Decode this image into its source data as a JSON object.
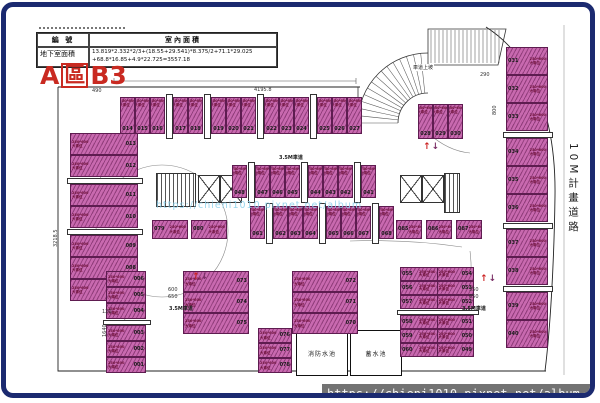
{
  "header": {
    "title": "A區B3",
    "title_parts": {
      "p1": "A",
      "p2": "區",
      "p3": "B3"
    },
    "table": {
      "col1_header": "編 號",
      "col2_header": "室內面積",
      "row_label": "地下室面積",
      "formula_line1": "13.819*2.332*2/3+(18.55+29.541)*8.375/2+71.1*29.025",
      "formula_line2": "+68.8*16.85+4.9*22.725=3557.18"
    }
  },
  "labels": {
    "road": "10M計畫道路",
    "ramp": "車道上坡",
    "aisle": "3.5M車道",
    "stall_note_line1": "250*600",
    "stall_note_line2": "大車位",
    "room1": "消防水池",
    "room2": "蓄水池"
  },
  "icons": {
    "up_arrow": "↑",
    "down_arrow": "↓"
  },
  "watermark": {
    "url": "https://chieni1010.pixnet.net/album"
  },
  "dimensions": {
    "top": "4195.8",
    "left": "490",
    "right_top": "290",
    "right_mid": "800",
    "aisle_a": "600",
    "aisle_b": "650",
    "aisle_c": "550",
    "aisle_d": "650",
    "bottom_left": "1640",
    "left_side": "3218.5",
    "left_bottom": "120"
  },
  "stalls": {
    "top_row": [
      "014",
      "015",
      "016",
      "017",
      "018",
      "019",
      "020",
      "021",
      "022",
      "023",
      "024",
      "025",
      "026",
      "027"
    ],
    "left_col": [
      "013",
      "012",
      "011",
      "010",
      "009",
      "008",
      "007"
    ],
    "left_col_bottom": [
      "006",
      "005",
      "004",
      "003",
      "002",
      "001"
    ],
    "right_col": [
      "031",
      "032",
      "033",
      "034",
      "035",
      "036",
      "037",
      "038",
      "039",
      "040"
    ],
    "under_ramp": [
      "028",
      "029",
      "030"
    ],
    "mid_up": [
      "048",
      "047",
      "046",
      "045",
      "044",
      "043",
      "042",
      "041"
    ],
    "mid_down": [
      "061",
      "062",
      "063",
      "064",
      "065",
      "066",
      "067",
      "068"
    ],
    "mid_down_left": [
      "079",
      "080"
    ],
    "mid_down_right": [
      "085",
      "086",
      "087"
    ],
    "block_a": [
      "073",
      "074",
      "075"
    ],
    "block_b": [
      "072",
      "071",
      "070"
    ],
    "block_c_left": [
      "055",
      "056",
      "057",
      "058",
      "059",
      "060"
    ],
    "block_c_right": [
      "054",
      "053",
      "052",
      "051",
      "050",
      "049"
    ],
    "col_076": [
      "076",
      "077",
      "078"
    ]
  },
  "colors": {
    "frame_navy": "#1b2a70",
    "stall_fill": "#c869af",
    "stall_border": "#5e1c50",
    "note_red": "#6d1038",
    "title_red": "#c92a21",
    "watermark_blue": "#8fd2ec",
    "bar_bg": "#646464",
    "bar_text": "#f5f5f5"
  }
}
